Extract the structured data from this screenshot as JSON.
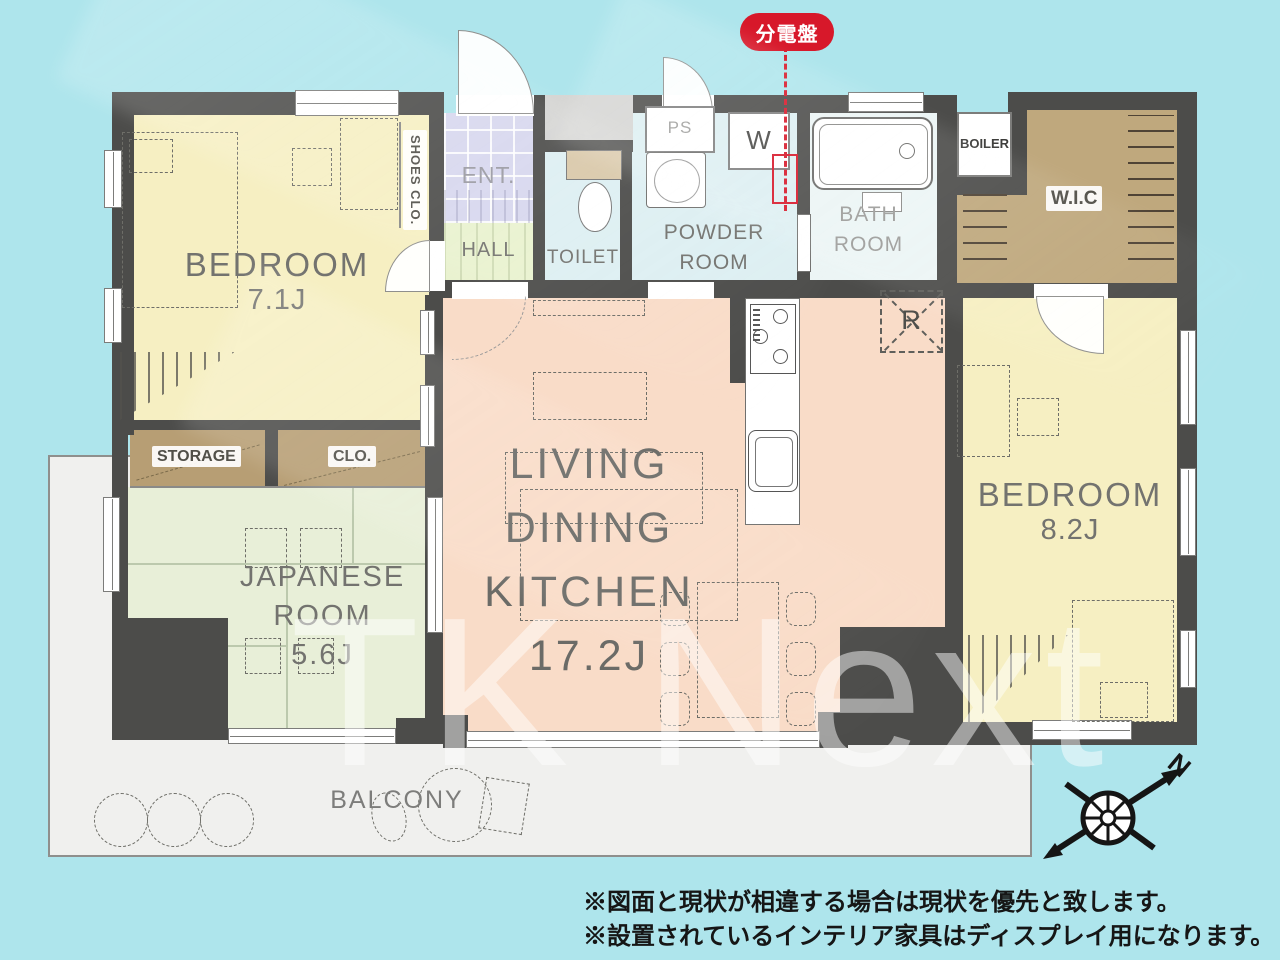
{
  "badge": {
    "label": "分電盤",
    "color": "#d7182a"
  },
  "rooms": {
    "bedroom1": {
      "name": "BEDROOM",
      "size": "7.1J"
    },
    "shoes_clo": {
      "label": "SHOES CLO."
    },
    "ent": {
      "label": "ENT."
    },
    "hall": {
      "label": "HALL"
    },
    "toilet": {
      "label": "TOILET"
    },
    "powder": {
      "l1": "POWDER",
      "l2": "ROOM"
    },
    "bath": {
      "l1": "BATH",
      "l2": "ROOM"
    },
    "ps": {
      "label": "PS"
    },
    "washer": {
      "label": "W"
    },
    "boiler": {
      "label": "BOILER"
    },
    "wic": {
      "label": "W.I.C"
    },
    "fridge": {
      "label": "R"
    },
    "bedroom2": {
      "name": "BEDROOM",
      "size": "8.2J"
    },
    "ldk": {
      "l1": "LIVING",
      "l2": "DINING",
      "l3": "KITCHEN",
      "size": "17.2J"
    },
    "storage": {
      "label": "STORAGE"
    },
    "clo": {
      "label": "CLO."
    },
    "japanese": {
      "l1": "JAPANESE",
      "l2": "ROOM",
      "size": "5.6J"
    },
    "balcony": {
      "label": "BALCONY"
    }
  },
  "compass": {
    "label": "N"
  },
  "watermark": {
    "text": "TK Next"
  },
  "notes": [
    "※図面と現状が相違する場合は現状を優先と致します。",
    "※設置されているインテリア家具はディスプレイ用になります。"
  ],
  "colors": {
    "background": "#aee5ec",
    "wall": "#4c4c4a",
    "bedroom": "#f6efc2",
    "ldk": "#f9dcc8",
    "japanese_room": "#e8efd8",
    "hall": "#e9f2cf",
    "entrance": "#d7d7ee",
    "water": "#ddeff2",
    "bath": "#ecf5f5",
    "closet": "#bfa87d",
    "balcony": "#f0f0ee",
    "alert": "#d7182a"
  }
}
